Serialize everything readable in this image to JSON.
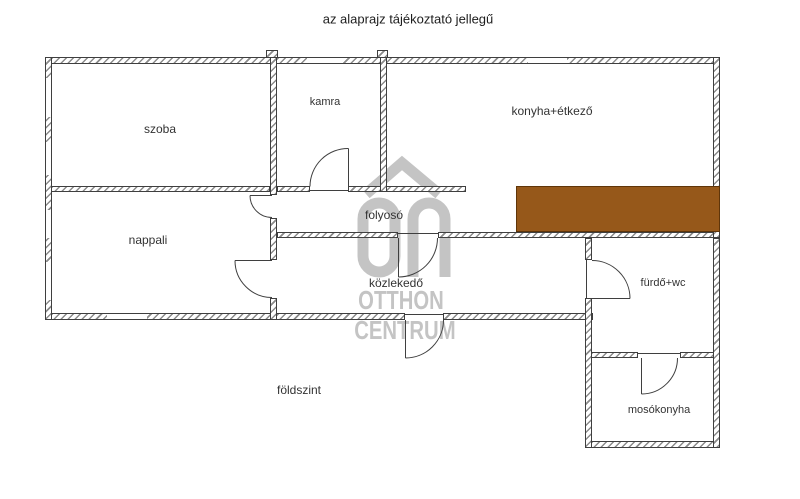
{
  "title": "az alaprajz tájékoztató jellegű",
  "floor_label": "földszint",
  "rooms": {
    "szoba": {
      "label": "szoba"
    },
    "kamra": {
      "label": "kamra"
    },
    "konyha": {
      "label": "konyha+étkező"
    },
    "nappali": {
      "label": "nappali"
    },
    "folyoso": {
      "label": "folyosó"
    },
    "kozlekedo": {
      "label": "közlekedő"
    },
    "furdo": {
      "label": "fürdő+wc"
    },
    "mosokonyha": {
      "label": "mosókonyha"
    }
  },
  "watermark": {
    "logo_text": "OC",
    "brand_line1": "OTTHON",
    "brand_line2": "CENTRUM"
  },
  "colors": {
    "highlight_brown": "#96581a",
    "watermark_gray": "#c4c4c4",
    "wall_line": "#3f3f3f"
  }
}
